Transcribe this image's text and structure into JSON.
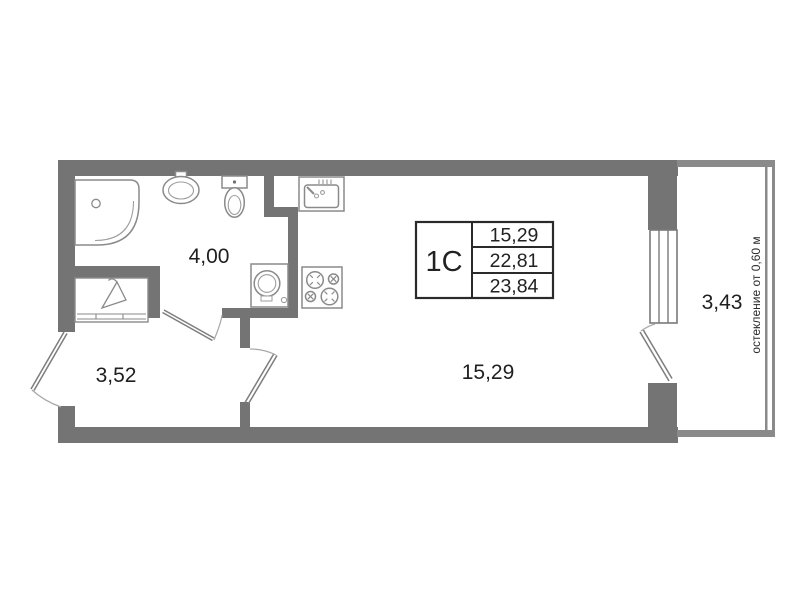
{
  "unit_card": {
    "unit_type": "1С",
    "area_rows": [
      "15,29",
      "22,81",
      "23,84"
    ]
  },
  "room_labels": {
    "bathroom": "4,00",
    "hallway": "3,52",
    "living_room": "15,29",
    "balcony": "3,43"
  },
  "annotations": {
    "glazing_note": "остекление от 0,60 м"
  },
  "legend": {
    "icons": [
      "shower-icon",
      "washbasin-icon",
      "toilet-icon",
      "kitchen-sink-icon",
      "stove-icon",
      "washing-machine-icon",
      "wardrobe-hanger-icon",
      "door-swing-icon",
      "window-icon"
    ]
  },
  "colors": {
    "wall": "#747474",
    "fixture_outline": "#8a8a8a",
    "detail_outline": "#9e9e9e",
    "table_border": "#2a2a2a",
    "text": "#1f1f1f",
    "background": "#ffffff"
  }
}
